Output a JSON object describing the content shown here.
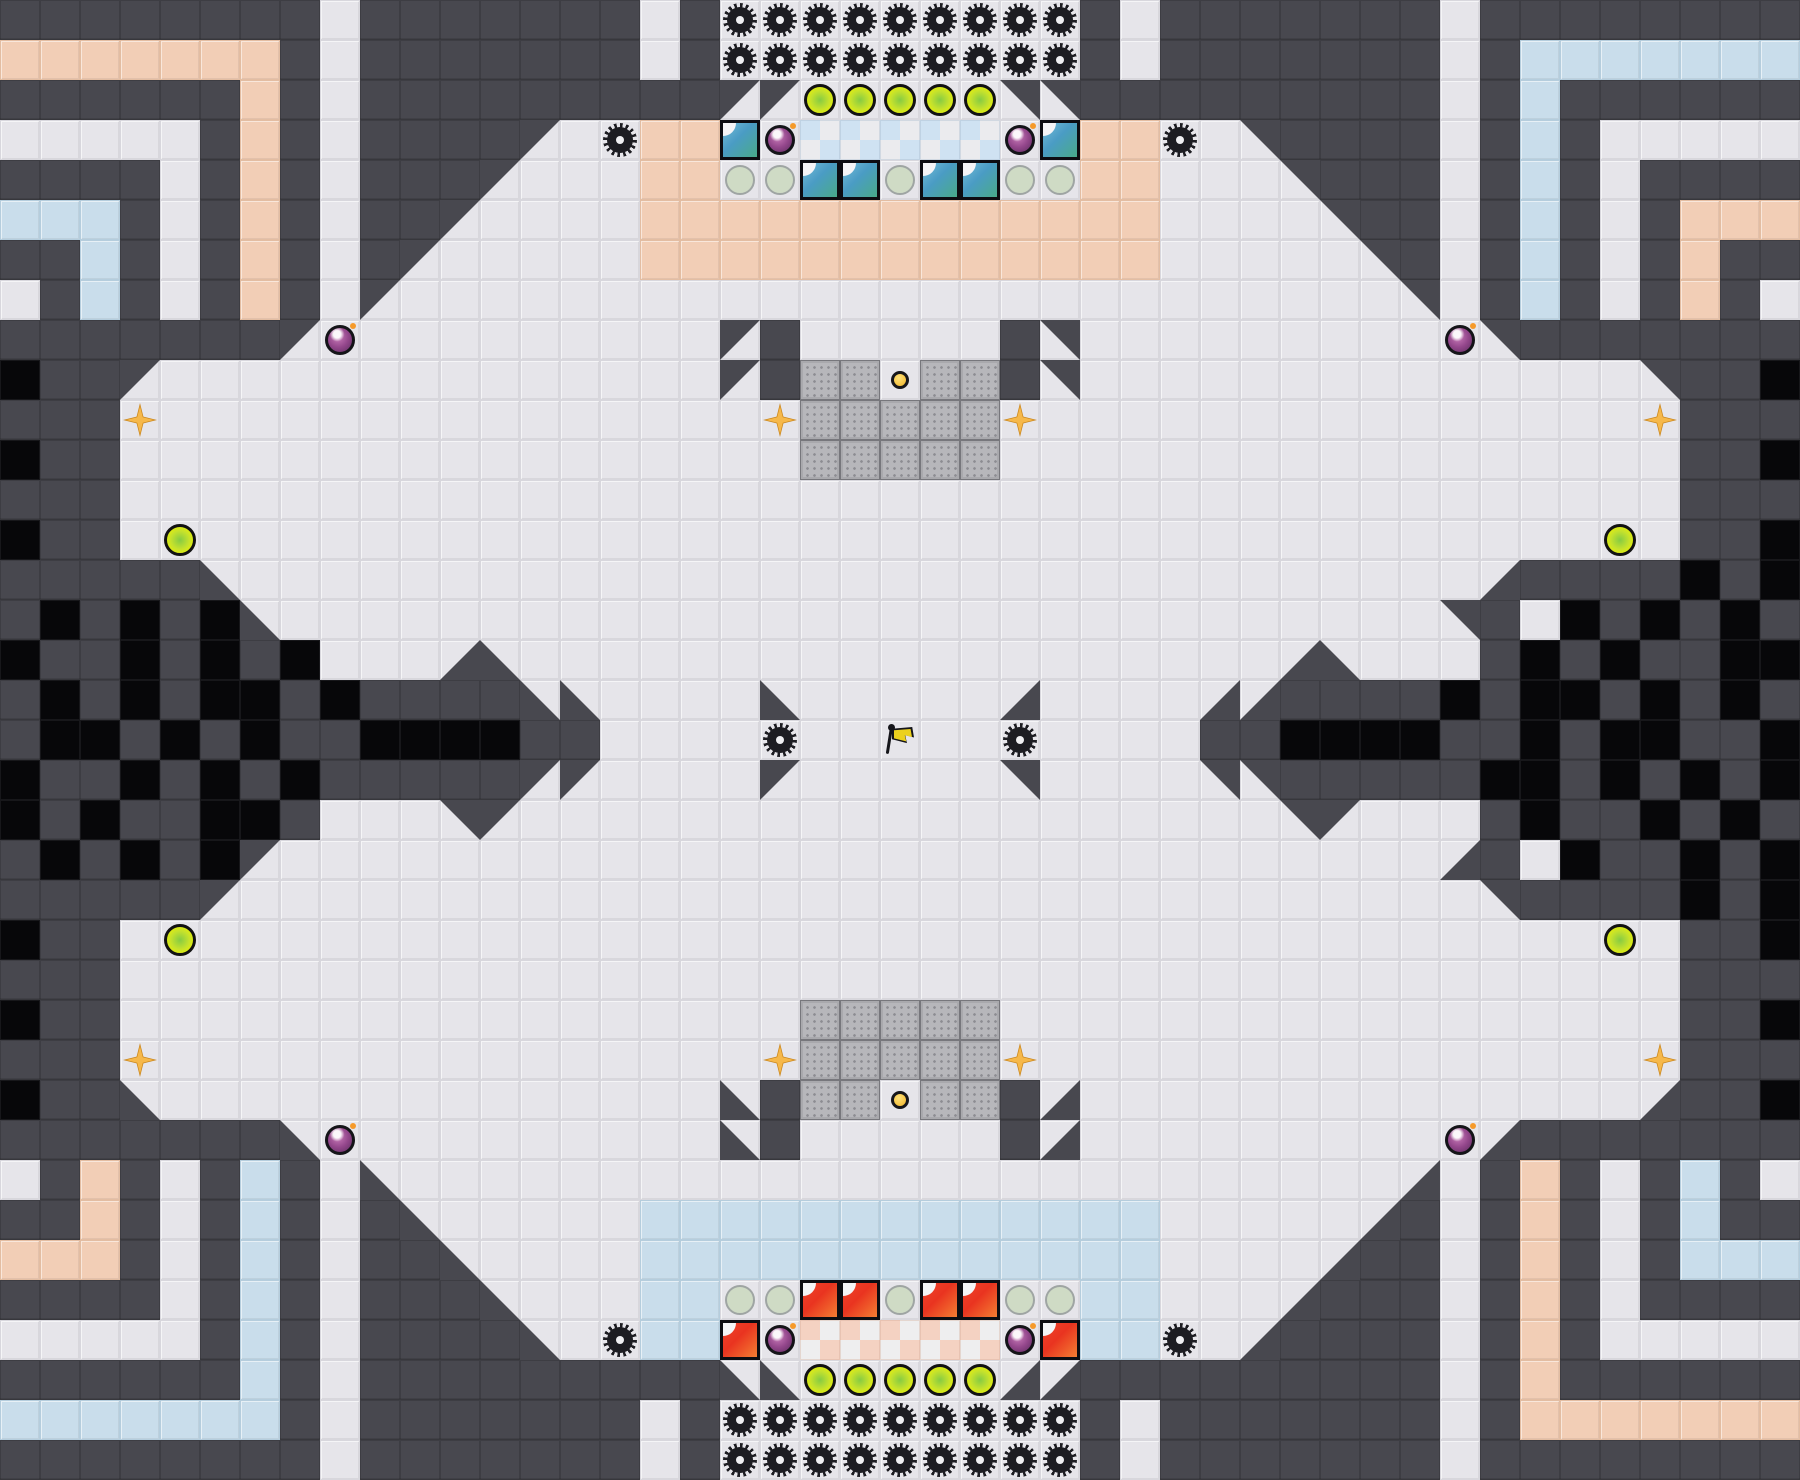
{
  "meta": {
    "type": "tile-based capture-the-flag game map",
    "grid_cols": 45,
    "grid_rows": 37,
    "tile_px": 40,
    "width_px": 1800,
    "height_px": 1480
  },
  "palette": {
    "wall": "#48484f",
    "void_black": "#070709",
    "floor": "#e6e5ea",
    "peach_floor": "#f2ceb6",
    "blue_floor": "#c9ddeb",
    "blue_endzone_check": "#cfe2f2",
    "red_endzone_check": "#f4d2c2",
    "gate_gray": "#b7b7bb",
    "team_blue": "#4a9cc4",
    "team_blue_green": "#49ad80",
    "team_red": "#e93420",
    "team_red_orange": "#f68a35",
    "spike_black": "#1d1d22",
    "powerup_yellow": "#e9f103",
    "powerup_green": "#86cb43",
    "pale_circle": "#cfdbc5",
    "bomb_purple": "#94478c",
    "bomb_spark_orange": "#f59a2a",
    "boost_orange": "#f6b84a",
    "button_yellow": "#f0b429",
    "flag_yellow": "#ecd11d"
  },
  "legend": {
    "#": {
      "name": "wall-tile",
      "base": "wall",
      "icon": null,
      "interactable": false
    },
    ".": {
      "name": "floor-tile",
      "base": "floor",
      "icon": null,
      "interactable": false
    },
    "X": {
      "name": "void-tile",
      "base": "void",
      "icon": null,
      "interactable": false
    },
    "p": {
      "name": "peach-floor-tile",
      "base": "peach",
      "icon": null,
      "interactable": false
    },
    "b": {
      "name": "blue-floor-tile",
      "base": "blue",
      "icon": null,
      "interactable": false
    },
    "z": {
      "name": "blue-endzone-tile",
      "base": "ezb",
      "icon": null,
      "interactable": false
    },
    "r": {
      "name": "red-endzone-tile",
      "base": "ezr",
      "icon": null,
      "interactable": false
    },
    "B": {
      "name": "blue-team-tile",
      "base": "teamb",
      "icon": null,
      "interactable": false
    },
    "R": {
      "name": "red-team-tile",
      "base": "teamr",
      "icon": null,
      "interactable": false
    },
    "g": {
      "name": "gate-tile",
      "base": "gate",
      "icon": null,
      "interactable": true
    },
    "1": {
      "name": "wall-triangle-tl",
      "base": "floor",
      "icon": "tri tri-tl",
      "interactable": false
    },
    "2": {
      "name": "wall-triangle-tr",
      "base": "floor",
      "icon": "tri tri-tr",
      "interactable": false
    },
    "3": {
      "name": "wall-triangle-br",
      "base": "floor",
      "icon": "tri tri-br",
      "interactable": false
    },
    "4": {
      "name": "wall-triangle-bl",
      "base": "floor",
      "icon": "tri tri-bl",
      "interactable": false
    },
    "s": {
      "name": "spike-icon",
      "base": "floor",
      "icon": "spike",
      "interactable": false
    },
    "o": {
      "name": "powerup-icon",
      "base": "floor",
      "icon": "powerup",
      "interactable": true
    },
    "c": {
      "name": "pad-circle-icon",
      "base": "floor",
      "icon": "palec",
      "interactable": false
    },
    "m": {
      "name": "bomb-icon",
      "base": "floor",
      "icon": "bomb",
      "interactable": true
    },
    "t": {
      "name": "boost-icon",
      "base": "floor",
      "icon": "boost",
      "interactable": true
    },
    "u": {
      "name": "button-icon",
      "base": "floor",
      "icon": "button",
      "interactable": true
    },
    "f": {
      "name": "flag-icon",
      "base": "floor",
      "icon": "flag",
      "interactable": true
    }
  },
  "objects_summary": {
    "flags": 1,
    "buttons": 2,
    "gates": 28,
    "spikes": 42,
    "bombs": 8,
    "boosts": 8,
    "powerup_circles": 14,
    "pale_circles": 10,
    "blue_team_tiles": 6,
    "red_team_tiles": 6,
    "blue_endzone_tiles": 5,
    "red_endzone_tiles": 5,
    "flag_tile": {
      "col": 22,
      "row": 18
    },
    "top_button_tile": {
      "col": 22,
      "row": 9
    },
    "bottom_button_tile": {
      "col": 22,
      "row": 27
    }
  },
  "map": {
    "rows": [
      "########.#######.#sssssssss#.#######.########",
      "ppppppp#.#######.#sssssssss#.#######.#bbbbbbb",
      "######p#.#########11ooooo22#########.#b######",
      ".....#p#.####1.sppBmzzzzzmBpps.2####.#b#.....",
      "####.#p#.###1...ppccBBcBBccpp...2###.#b#.####",
      "bbb#.#p#.##1....ppppppppppppp....2##.#b#.#ppp",
      "##b#.#p#.#1.....ppppppppppppp.....2#.#b#.#p##",
      ".#b#.#p#.1.........................2.#b#.#p#.",
      "#######1m.........1#.....#2.........m2#######",
      "X##1..............1#ggugg#2..............2##X",
      "###t...............tgggggt...............t###",
      "X##.................ggggg.................##X",
      "###.......................................###",
      "X##.o...................................o.##X",
      "#####4...............................3####X#X",
      "#X#X#X4.............................2#.X#X#X#",
      "X##X#X#X...34...................34...#X#X##XX",
      "#X#X#XX#X####44....4.....3....33####X#XX#X#X#",
      "#XX#X#X##XXXX##....s..f..s....##XXXX##X#XX##X",
      "X##X#X#X#####11....1.....2....22#####XX#X#X#X",
      "X#X##XX#...21...................21...#X##X#X#",
      "#X#X#X1.............................3#.X##X#X",
      "#####1...............................2####X#X",
      "X##.o...................................o.##X",
      "###.......................................###",
      "X##.................ggggg.................##X",
      "###t...............tgggggt...............t###",
      "X##4..............4#ggugg#3..............3##X",
      "#######4m.........4#.....#3.........m3#######",
      ".#p#.#b#.4.........................3.#p#.#b#.",
      "##p#.#b#.#4.....bbbbbbbbbbbbb.....3#.#p#.#b##",
      "ppp#.#b#.##4....bbbbbbbbbbbbb....3##.#p#.#bbb",
      "####.#b#.###4...bbccRRcRRccbb...3###.#p#.####",
      ".....#b#.####4.sbbRmrrrrrmRbbs.3####.#p#.....",
      "######b#.#########44ooooo33#########.#p######",
      "bbbbbbb#.#######.#sssssssss#.#######.#ppppppp",
      "########.#######.#sssssssss#.#######.########"
    ]
  }
}
